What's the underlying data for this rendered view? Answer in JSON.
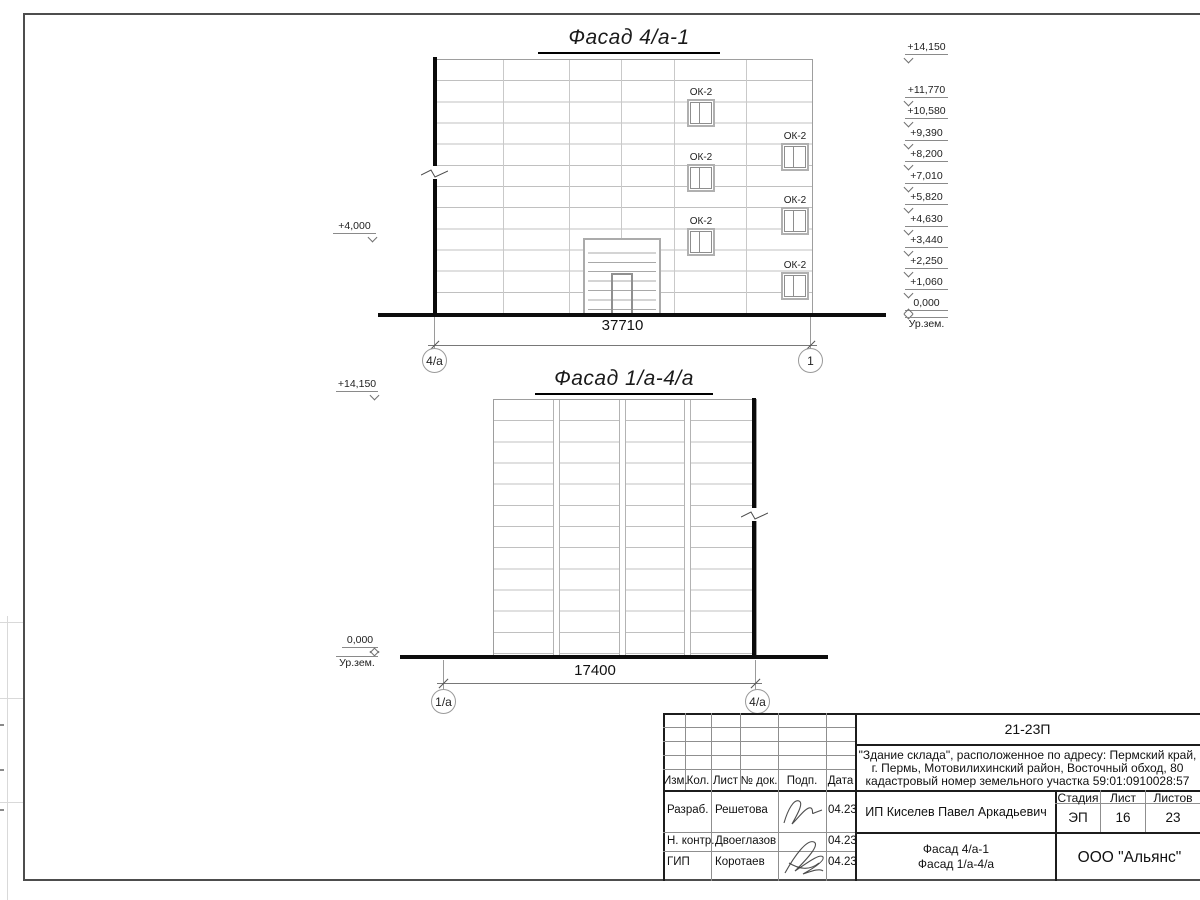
{
  "facade1": {
    "title": "Фасад 4/а-1",
    "window_label": "ОК-2",
    "dimension": "37710",
    "axis_left": "4/а",
    "axis_right": "1",
    "elevation_left": "+4,000",
    "elevations_right": [
      "+14,150",
      "+11,770",
      "+10,580",
      "+9,390",
      "+8,200",
      "+7,010",
      "+5,820",
      "+4,630",
      "+3,440",
      "+2,250",
      "+1,060",
      "0,000"
    ],
    "ground_label": "Ур.зем."
  },
  "facade2": {
    "title": "Фасад 1/а-4/а",
    "elevation_top": "+14,150",
    "elevation_zero": "0,000",
    "ground_label": "Ур.зем.",
    "dimension": "17400",
    "axis_left": "1/а",
    "axis_right": "4/а"
  },
  "titleblock": {
    "doc_number": "21-23П",
    "project_line1": "\"Здание склада\", расположенное по адресу: Пермский край,",
    "project_line2": "г. Пермь, Мотовилихинский район, Восточный обход, 80",
    "project_line3": "кадастровый номер земельного участка 59:01:0910028:57",
    "col_izm": "Изм.",
    "col_kol": "Кол.",
    "col_list": "Лист",
    "col_doc": "№ док.",
    "col_podp": "Подп.",
    "col_data": "Дата",
    "rows": [
      {
        "role": "Разраб.",
        "name": "Решетова",
        "date": "04.23"
      },
      {
        "role": "Н. контр.",
        "name": "Двоеглазов",
        "date": "04.23"
      },
      {
        "role": "ГИП",
        "name": "Коротаев",
        "date": "04.23"
      }
    ],
    "client": "ИП Киселев Павел Аркадьевич",
    "stage_label": "Стадия",
    "sheet_label": "Лист",
    "sheets_label": "Листов",
    "stage": "ЭП",
    "sheet_no": "16",
    "sheets_total": "23",
    "content_line1": "Фасад 4/а-1",
    "content_line2": "Фасад 1/а-4/а",
    "company": "ООО \"Альянс\""
  }
}
